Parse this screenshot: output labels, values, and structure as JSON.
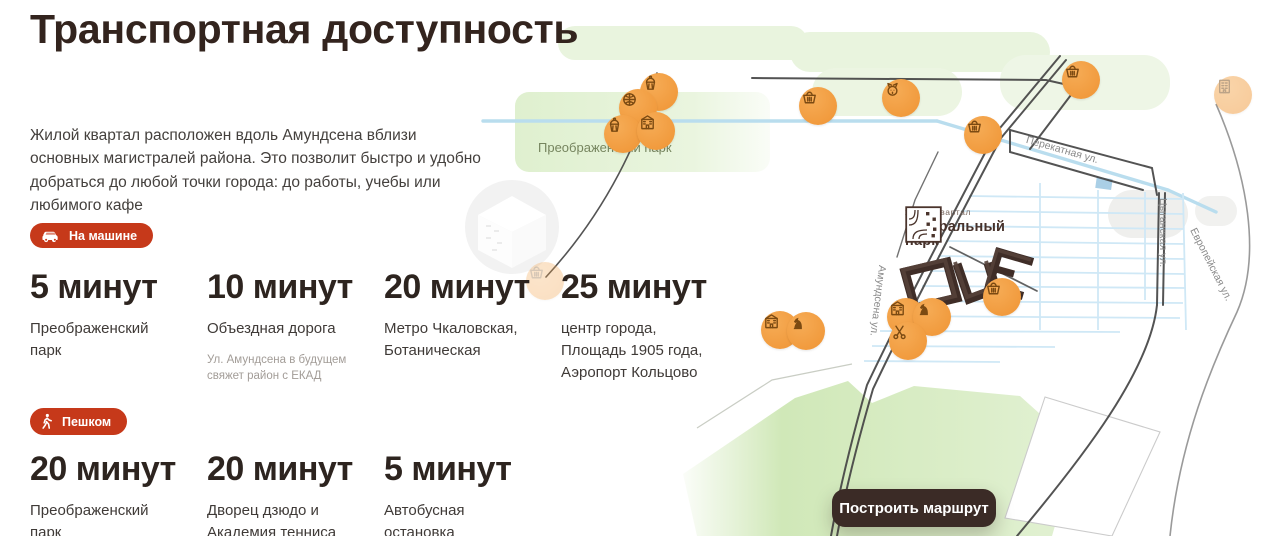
{
  "header": {
    "title": "Транспортная доступность",
    "description": "Жилой квартал расположен вдоль Амундсена вблизи основных магистралей района. Это позволит быстро и удобно добраться до любой точки города: до работы, учебы или любимого кафе"
  },
  "colors": {
    "accent_red": "#c6391a",
    "marker_orange": "#ef9434",
    "building_brown": "#46312a",
    "button_bg": "#3b2b26",
    "park_green": "#d7ebc0",
    "water_blue": "#b9ddee"
  },
  "sections": {
    "car": {
      "badge": "На машине",
      "items": [
        {
          "time": "5 минут",
          "place": "Преображенский парк"
        },
        {
          "time": "10 минут",
          "place": "Объездная дорога",
          "note": "Ул. Амундсена в будущем свяжет район с ЕКАД"
        },
        {
          "time": "20 минут",
          "place": "Метро Чкаловская, Ботаническая"
        },
        {
          "time": "25 минут",
          "place": "центр города, Площадь 1905 года, Аэропорт Кольцово"
        }
      ]
    },
    "walk": {
      "badge": "Пешком",
      "items": [
        {
          "time": "20 минут",
          "place": "Преображенский парк"
        },
        {
          "time": "20 минут",
          "place": "Дворец дзюдо и Академия тенниса"
        },
        {
          "time": "5 минут",
          "place": "Автобусная остановка"
        }
      ]
    }
  },
  "map": {
    "park_label": "Преображенский парк",
    "streets": {
      "perekatnaya": "Перекатная ул.",
      "tsyganskaya": "Цыганская ул.",
      "evropeyskaya": "Европейская ул.",
      "amundsena": "Амундсена ул."
    },
    "logo": {
      "tagline": "жилой квартал",
      "line1": "центральный",
      "line2": "парк"
    },
    "route_button": "Построить маршрут",
    "markers": [
      {
        "x": 659,
        "y": 92,
        "icon": "cupcake-icon",
        "opacity": 1
      },
      {
        "x": 638,
        "y": 108,
        "icon": "sports-ball-icon",
        "opacity": 1
      },
      {
        "x": 623,
        "y": 134,
        "icon": "cupcake-icon",
        "opacity": 1
      },
      {
        "x": 656,
        "y": 131,
        "icon": "school-icon",
        "opacity": 1
      },
      {
        "x": 818,
        "y": 106,
        "icon": "basket-icon",
        "opacity": 1
      },
      {
        "x": 901,
        "y": 98,
        "icon": "pet-icon",
        "opacity": 1
      },
      {
        "x": 983,
        "y": 135,
        "icon": "basket-icon",
        "opacity": 1
      },
      {
        "x": 1081,
        "y": 80,
        "icon": "basket-icon",
        "opacity": 1
      },
      {
        "x": 1233,
        "y": 95,
        "icon": "building-icon",
        "opacity": 0.5
      },
      {
        "x": 545,
        "y": 281,
        "icon": "basket-icon",
        "opacity": 0.3
      },
      {
        "x": 780,
        "y": 330,
        "icon": "school-icon",
        "opacity": 1
      },
      {
        "x": 806,
        "y": 331,
        "icon": "chess-knight-icon",
        "opacity": 1
      },
      {
        "x": 906,
        "y": 317,
        "icon": "school-icon",
        "opacity": 1
      },
      {
        "x": 932,
        "y": 317,
        "icon": "chess-knight-icon",
        "opacity": 1
      },
      {
        "x": 908,
        "y": 341,
        "icon": "scissors-icon",
        "opacity": 1
      },
      {
        "x": 1002,
        "y": 297,
        "icon": "basket-icon",
        "opacity": 1
      }
    ]
  }
}
